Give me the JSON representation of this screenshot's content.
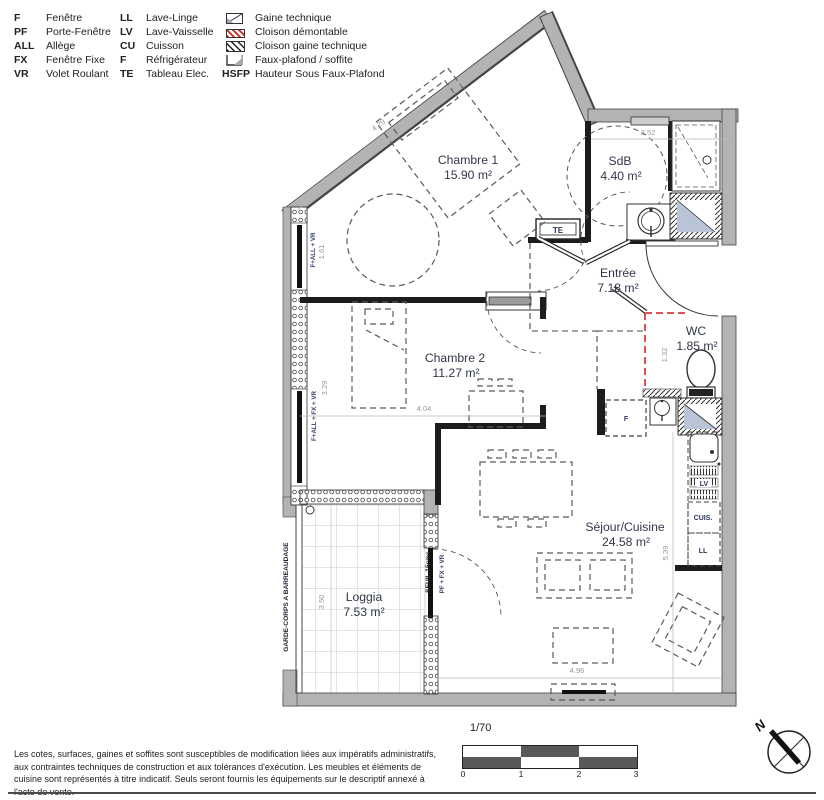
{
  "legend": {
    "col1": [
      {
        "abbr": "F",
        "label": "Fenêtre"
      },
      {
        "abbr": "PF",
        "label": "Porte-Fenêtre"
      },
      {
        "abbr": "ALL",
        "label": "Allège"
      },
      {
        "abbr": "FX",
        "label": "Fenêtre Fixe"
      },
      {
        "abbr": "VR",
        "label": "Volet Roulant"
      }
    ],
    "col2": [
      {
        "abbr": "LL",
        "label": "Lave-Linge"
      },
      {
        "abbr": "LV",
        "label": "Lave-Vaisselle"
      },
      {
        "abbr": "CU",
        "label": "Cuisson"
      },
      {
        "abbr": "F",
        "label": "Réfrigérateur"
      },
      {
        "abbr": "TE",
        "label": "Tableau Elec."
      }
    ],
    "col3": [
      {
        "label": "Gaine technique"
      },
      {
        "label": "Cloison démontable"
      },
      {
        "label": "Cloison gaine technique"
      },
      {
        "label": "Faux-plafond / soffite"
      },
      {
        "abbr": "HSFP",
        "label": "Hauteur Sous Faux-Plafond"
      }
    ]
  },
  "rooms": [
    {
      "name": "Chambre 1",
      "area": "15.90 m²"
    },
    {
      "name": "SdB",
      "area": "4.40 m²"
    },
    {
      "name": "Entrée",
      "area": "7.18 m²"
    },
    {
      "name": "WC",
      "area": "1.85 m²"
    },
    {
      "name": "Chambre 2",
      "area": "11.27 m²"
    },
    {
      "name": "Séjour/Cuisine",
      "area": "24.58 m²"
    },
    {
      "name": "Loggia",
      "area": "7.53 m²"
    }
  ],
  "dimensions": {
    "ch1_diag": "4.29",
    "sdb_width": "2.52",
    "ch1_window": "1.61",
    "ch2_window": "3.29",
    "ch2_width": "4.04",
    "wc_width": "1.32",
    "sejour_height": "5.39",
    "loggia_height": "3.50",
    "sejour_width": "4.96"
  },
  "annotations": {
    "garde_corps": "GARDE-CORPS A BARREAUDAGE",
    "seuil": "SEUIL 15cms",
    "loggia_door": "PF + FX + VR",
    "ch1_window_label": "F+ALL + VR",
    "ch2_window_label": "F+ALL + FX + VR",
    "te": "TE",
    "fridge": "F",
    "cuis": "CUIS.",
    "ll": "LL",
    "lv": "LV"
  },
  "scale": {
    "ratio": "1/70",
    "ticks": [
      "0",
      "1",
      "2",
      "3"
    ]
  },
  "compass": {
    "label": "N"
  },
  "disclaimer": "Les cotes, surfaces, gaines et soffites sont susceptibles de modification liées aux impératifs administratifs, aux contraintes techniques de construction et aux tolérances d'exécution. Les meubles et éléments de cuisine sont représentés à titre indicatif. Seuls seront fournis les équipements sur le descriptif annexé à l'acte de vente."
}
